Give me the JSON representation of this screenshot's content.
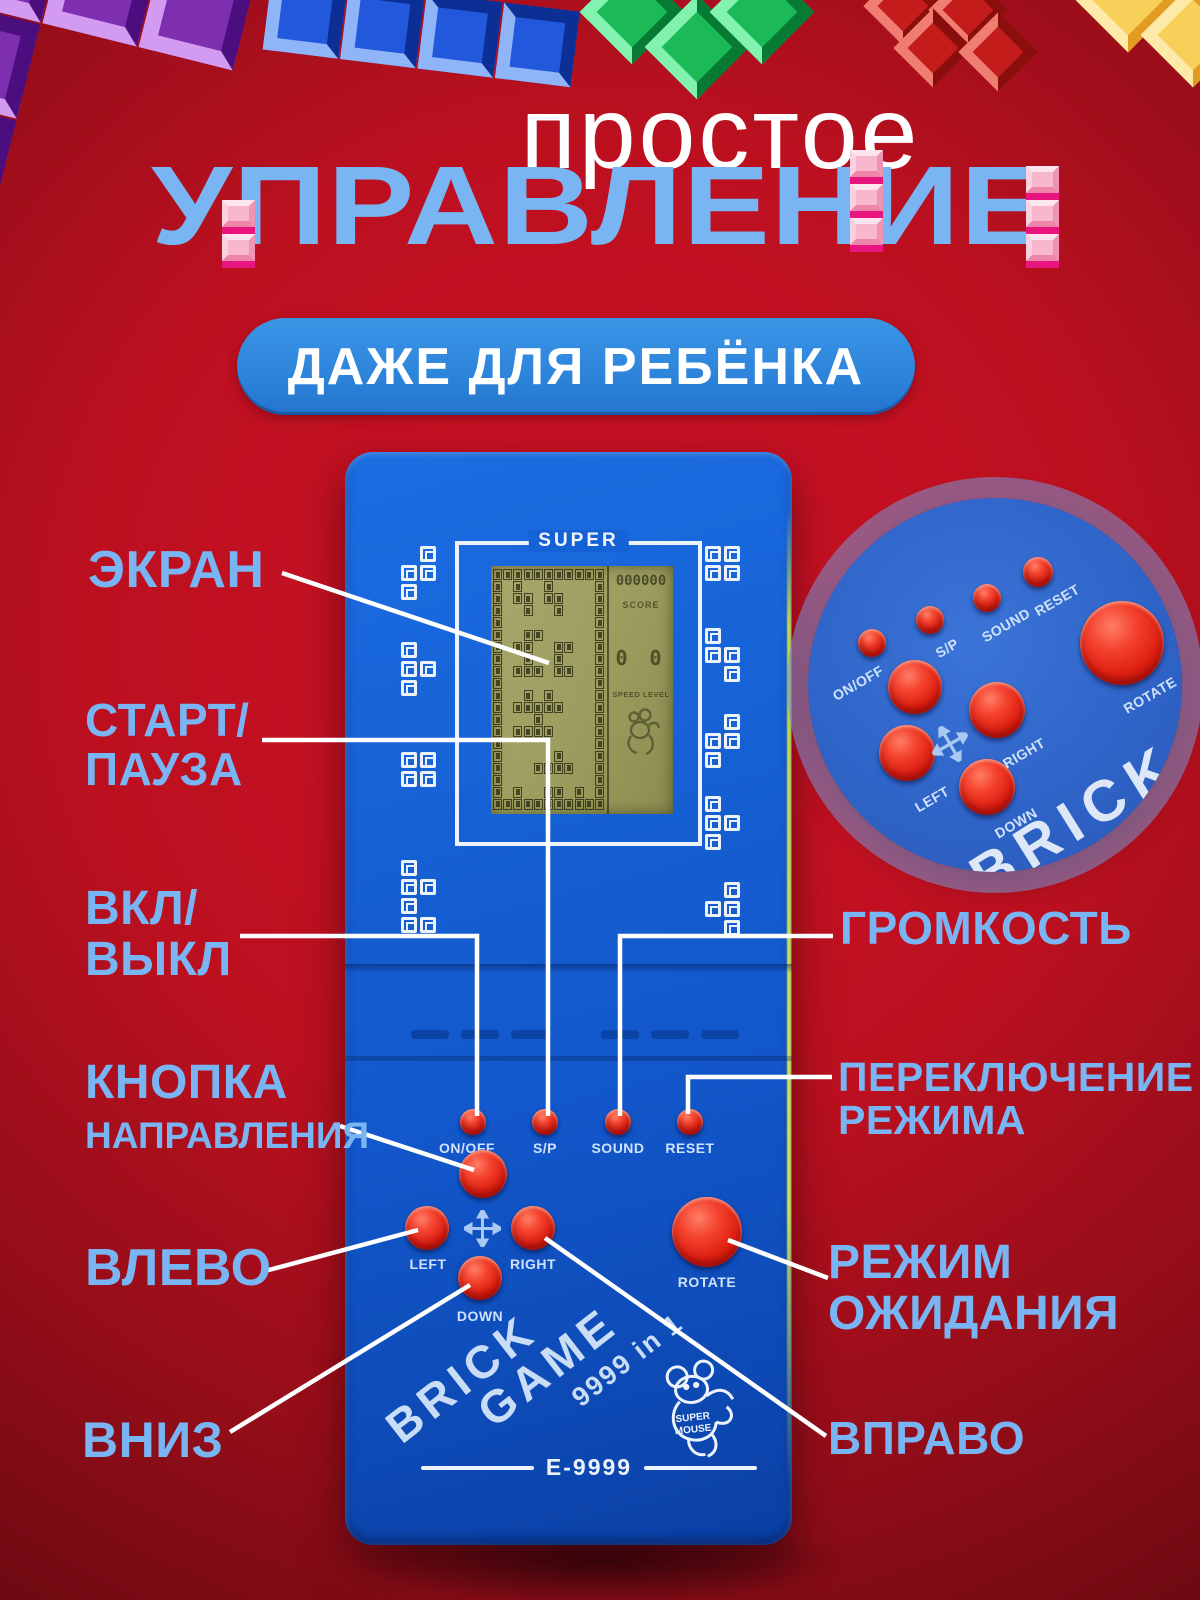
{
  "header": {
    "subtitle": "простое",
    "title": "УПРАВЛЕНИЕ",
    "badge": "ДАЖЕ ДЛЯ РЕБЁНКА"
  },
  "callouts": {
    "screen": {
      "line1": "ЭКРАН"
    },
    "start_pause": {
      "line1": "СТАРТ/",
      "line2": "ПАУЗА"
    },
    "power": {
      "line1": "ВКЛ/",
      "line2": "ВЫКЛ"
    },
    "direction": {
      "line1": "КНОПКА",
      "line2": "НАПРАВЛЕНИЯ"
    },
    "left": {
      "line1": "ВЛЕВО"
    },
    "down": {
      "line1": "ВНИЗ"
    },
    "volume": {
      "line1": "ГРОМКОСТЬ"
    },
    "mode_switch": {
      "line1": "ПЕРЕКЛЮЧЕНИЕ",
      "line2": "РЕЖИМА"
    },
    "standby": {
      "line1": "РЕЖИМ",
      "line2": "ОЖИДАНИЯ"
    },
    "right": {
      "line1": "ВПРАВО"
    }
  },
  "console": {
    "brand_top": "SUPER",
    "lcd": {
      "score_value": "000000",
      "score_label": "SCORE",
      "level_value": "0 0",
      "speed_label": "SPEED LEVEL",
      "pattern": [
        "11111111111",
        "10100100001",
        "10110110001",
        "10010010001",
        "10000000001",
        "10011000001",
        "10110011001",
        "10010010001",
        "10111011001",
        "10000000001",
        "10010100001",
        "10111110001",
        "10001000001",
        "10111100001",
        "10000000001",
        "10000010001",
        "10001111001",
        "10000000001",
        "10100110101",
        "11111111111"
      ]
    },
    "buttons": {
      "on_off": "ON/OFF",
      "start_pause": "S/P",
      "sound": "SOUND",
      "reset": "RESET",
      "left": "LEFT",
      "right": "RIGHT",
      "down": "DOWN",
      "rotate": "ROTATE"
    },
    "logo": {
      "word1": "BRICK",
      "word2": "GAME",
      "tagline": "9999 in 1",
      "mascot_line1": "SUPER",
      "mascot_line2": "MOUSE",
      "model": "E-9999"
    }
  },
  "colors": {
    "accent_text": "#79b5f3",
    "badge_bg": "#2e86dc",
    "console_body": "#1560d4",
    "button_red": "#de2012",
    "background_center": "#cf1226"
  }
}
